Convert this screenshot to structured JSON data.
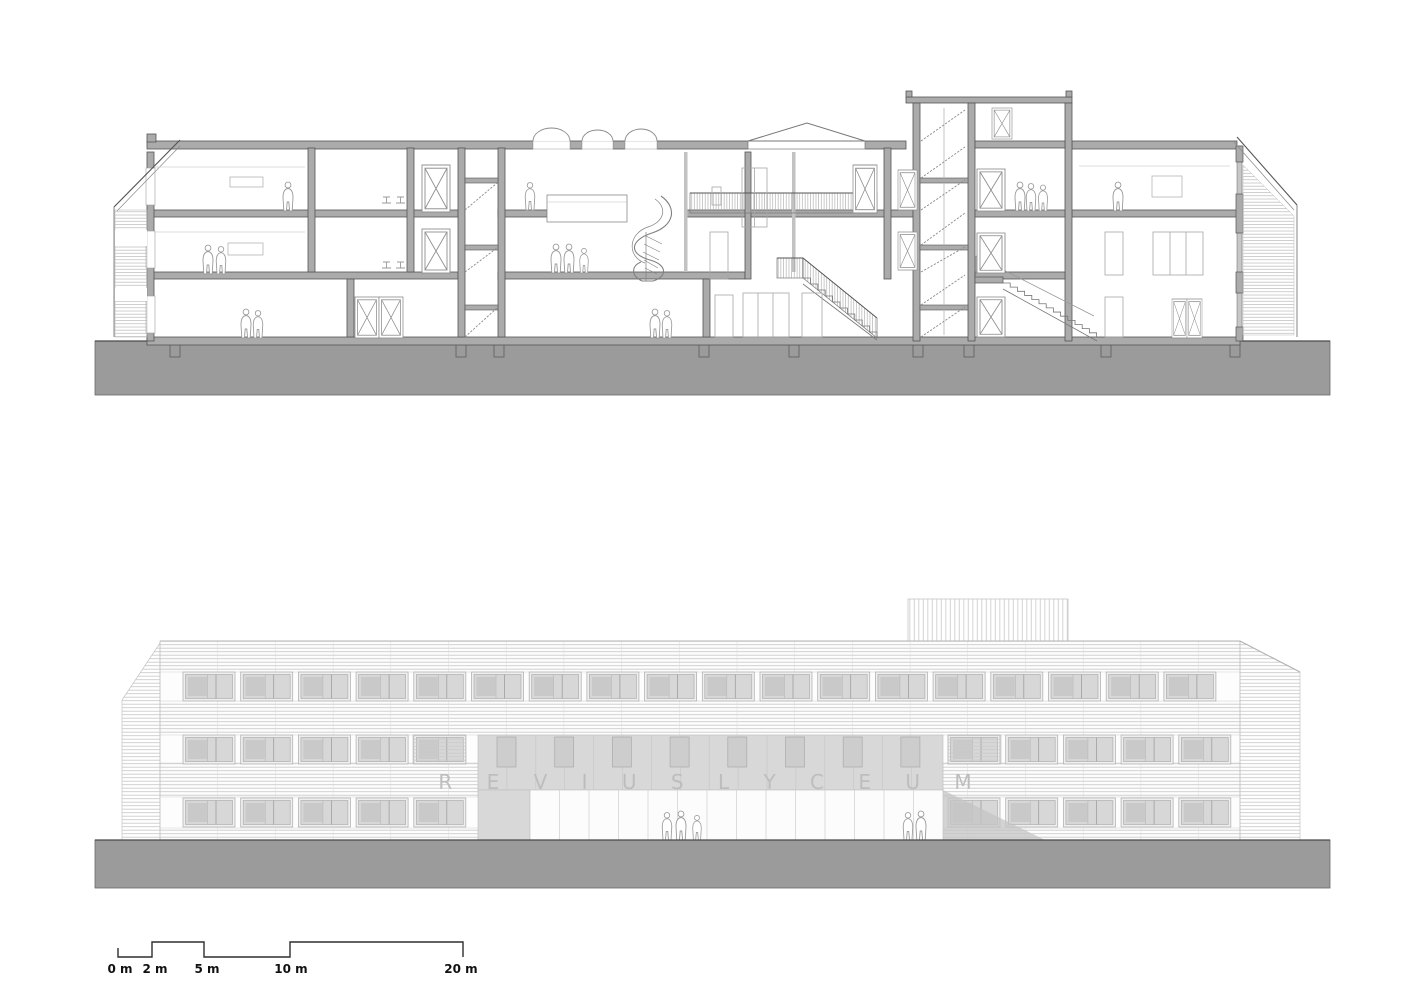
{
  "elevation": {
    "sign_text": "R E V I U S   L Y C E U M"
  },
  "scale_bar": {
    "labels": [
      "0 m",
      "2 m",
      "5 m",
      "10 m",
      "20 m"
    ]
  },
  "colors": {
    "background": "#ffffff",
    "ground_band": "#9b9b9b",
    "cut_wall": "#ababab",
    "outline_dark": "#555555",
    "hatch_light": "#c9c9c9",
    "panel_gray": "#d8d8d8",
    "sign_letters": "#bdbdbd",
    "scale_text": "#111111"
  }
}
